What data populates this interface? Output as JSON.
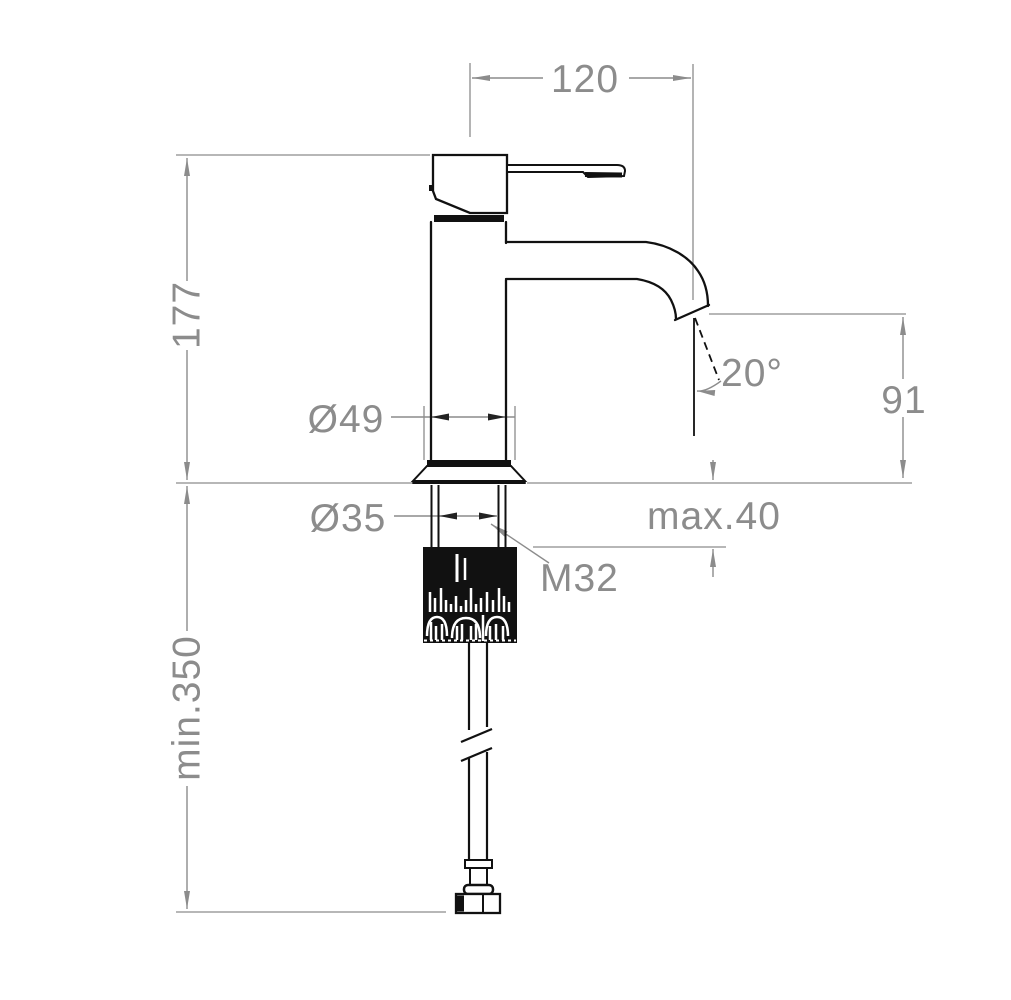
{
  "drawing": {
    "labels": {
      "spout_reach": "120",
      "total_height": "177",
      "spout_height": "91",
      "spout_angle": "20°",
      "body_diameter": "Ø49",
      "shank_diameter": "Ø35",
      "thread_size": "M32",
      "max_deck": "max.40",
      "min_hose": "min.350"
    },
    "colors": {
      "line": "#111111",
      "dimension": "#8c8c8c",
      "background": "#ffffff"
    }
  }
}
